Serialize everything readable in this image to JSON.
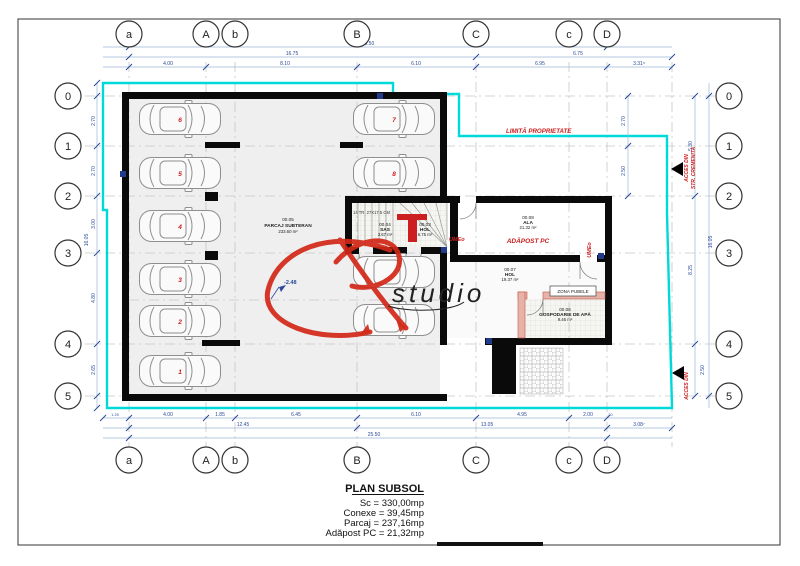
{
  "grid": {
    "cols": [
      "a",
      "A",
      "b",
      "B",
      "C",
      "c",
      "D"
    ],
    "rows": [
      "0",
      "1",
      "2",
      "3",
      "4",
      "5"
    ]
  },
  "dims": {
    "top": {
      "total": "25.50",
      "seg_left": "16.75",
      "seg_right": "6.75",
      "d1": "4.00",
      "d2": "8.10",
      "d3": "6.10",
      "d4": "6.95",
      "d5": "3.31⁵"
    },
    "bottom": {
      "d0": "1.25",
      "d1": "4.00",
      "d2": "1.85",
      "d3": "6.45",
      "d4": "6.10",
      "d5": "4.95",
      "d6": "2.00",
      "d7": ".20",
      "mid1": "12.45",
      "mid2": "13.05",
      "mid3": "3.08⁷",
      "total": "25.50"
    },
    "left": {
      "d1": "2.70",
      "d2": "2.70",
      "d3": "3.00",
      "d4": "4.80",
      "d5": "2.65",
      "total": "16.05"
    },
    "right": {
      "d1": "5.30",
      "d2": "8.25",
      "d3": "2.50",
      "total": "16.05",
      "inner1": "2.70",
      "inner2": "2.50"
    }
  },
  "rooms": {
    "parcaj": {
      "number": "00.05",
      "name": "PARCAJ SUBTERAN",
      "area": "233.60 m²"
    },
    "sas": {
      "number": "00.04",
      "name": "SAS",
      "area": "3.67 m²"
    },
    "hol1": {
      "number": "00.03",
      "name": "HOL",
      "area": "6.75 m²"
    },
    "ala": {
      "number": "00.08",
      "name": "ALA",
      "area": "21.32 m²"
    },
    "hol2": {
      "number": "00.07",
      "name": "HOL",
      "area": "19.37 m²"
    },
    "gospodarie": {
      "number": "00.06",
      "name": "GOSPODARIE DE APĂ",
      "area": "9.46 m²"
    }
  },
  "annotations": {
    "property_limit": "LIMITĂ PROPRIETATE",
    "shelter": "ADĂPOST PC",
    "ume1": "UMEo",
    "ume2": "UMEo",
    "access1_line1": "ACCES DIN",
    "access1_line2": "STR. CREMENITA",
    "access2": "ACCES DIN",
    "zona_pubele": "ZONA PUBELE",
    "stairs": "14 TR. 27X17.5 CM",
    "level": "-2.48"
  },
  "parking": {
    "numbers": [
      "6",
      "5",
      "4",
      "3",
      "2",
      "1",
      "7",
      "8"
    ]
  },
  "watermark": {
    "text": "studio"
  },
  "title_block": {
    "title": "PLAN SUBSOL",
    "line1": "Sc = 330,00mp",
    "line2": "Conexe = 39,45mp",
    "line3": "Parcaj = 237,16mp",
    "line4": "Adăpost PC = 21,32mp"
  },
  "colors": {
    "boundary": "#00d9d9",
    "annotation_red": "#cc1d1d",
    "dim_blue": "#2a4a9a",
    "wall": "#0a0a0a"
  }
}
